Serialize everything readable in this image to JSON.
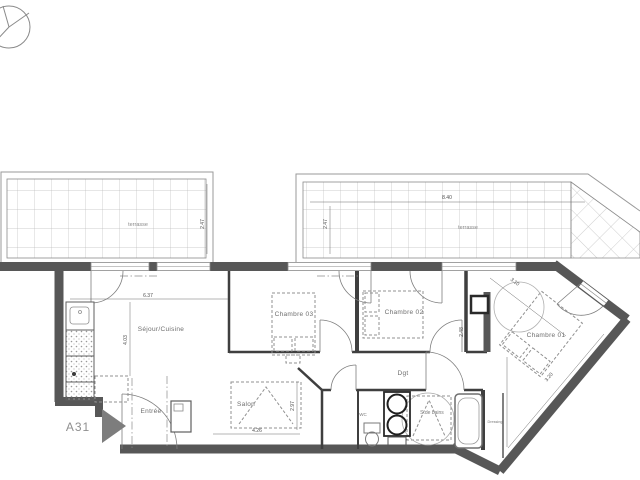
{
  "drawing": {
    "sheet_label": "A31",
    "rooms": {
      "terrasse_left": "terrasse",
      "terrasse_right": "terrasse",
      "sejour": "Séjour/Cuisine",
      "salon": "Salon",
      "entree": "Entrée",
      "chambre01": "Chambre 01",
      "chambre02": "Chambre 02",
      "chambre03": "Chambre 03",
      "dgt": "Dgt",
      "wc": "WC",
      "sdb": "S.de bains",
      "dressing": "Dressing"
    },
    "dimensions": {
      "sejour_width": "6.37",
      "sejour_height": "4.03",
      "salon_width": "4.26",
      "salon_height": "2.97",
      "terrasse_right_width": "8.40",
      "terrasse_right_depth": "2.47",
      "terrasse_left_depth": "2.47",
      "chambre02_depth": "2.48",
      "chambre01_top": "3.10",
      "chambre01_side": "3.20"
    },
    "icons": {
      "north": "north-compass-icon",
      "entrance_arrow": "entrance-arrow-icon"
    },
    "colors": {
      "background": "#ffffff",
      "wall": "#575757",
      "thin_line": "#8a8a8a",
      "grid": "#b8b8b8",
      "label": "#6e6e6e",
      "dim_text": "#4f4f4f"
    }
  }
}
